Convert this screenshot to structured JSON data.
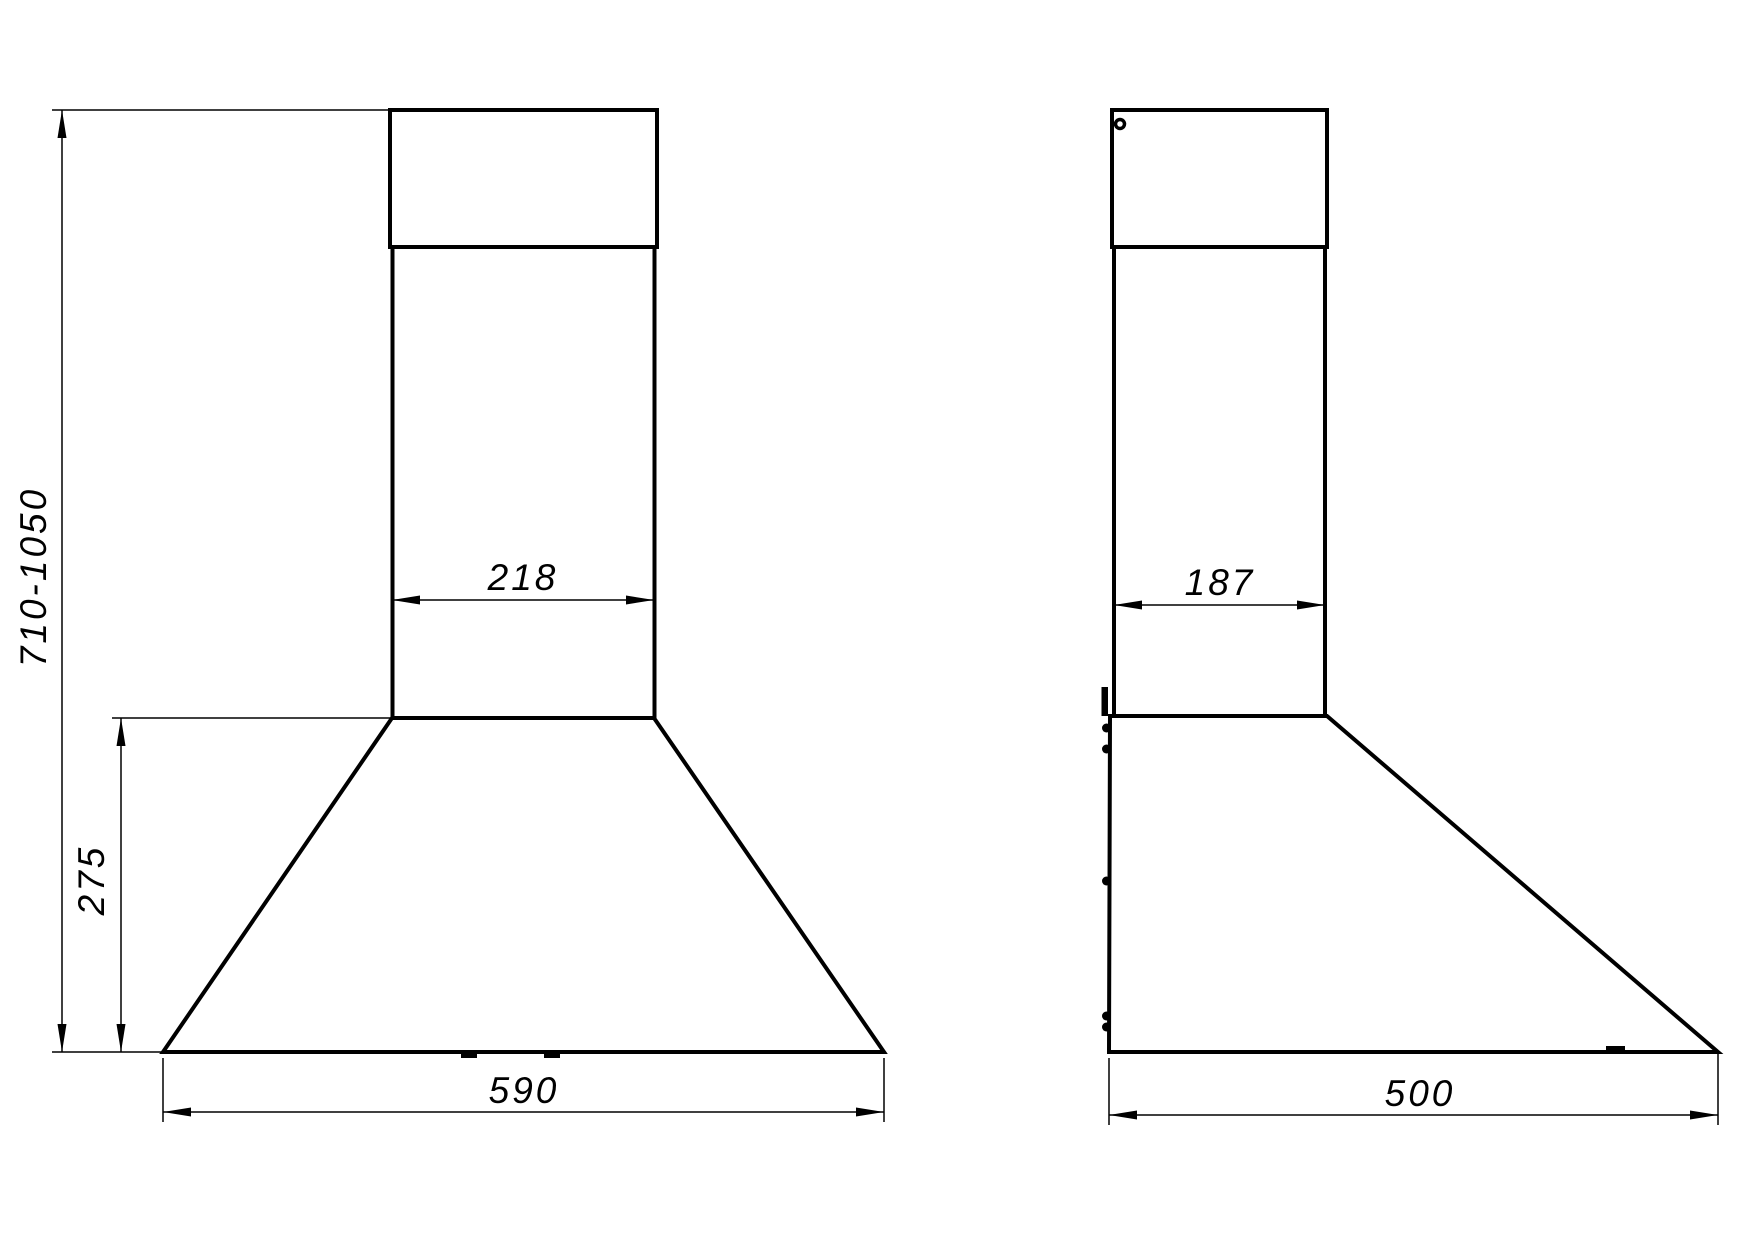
{
  "drawing": {
    "background_color": "#ffffff",
    "line_color": "#000000",
    "front_view": {
      "height_range_label": "710-1050",
      "chimney_width_label": "218",
      "body_height_label": "275",
      "body_width_label": "590"
    },
    "side_view": {
      "chimney_depth_label": "187",
      "body_depth_label": "500"
    }
  }
}
